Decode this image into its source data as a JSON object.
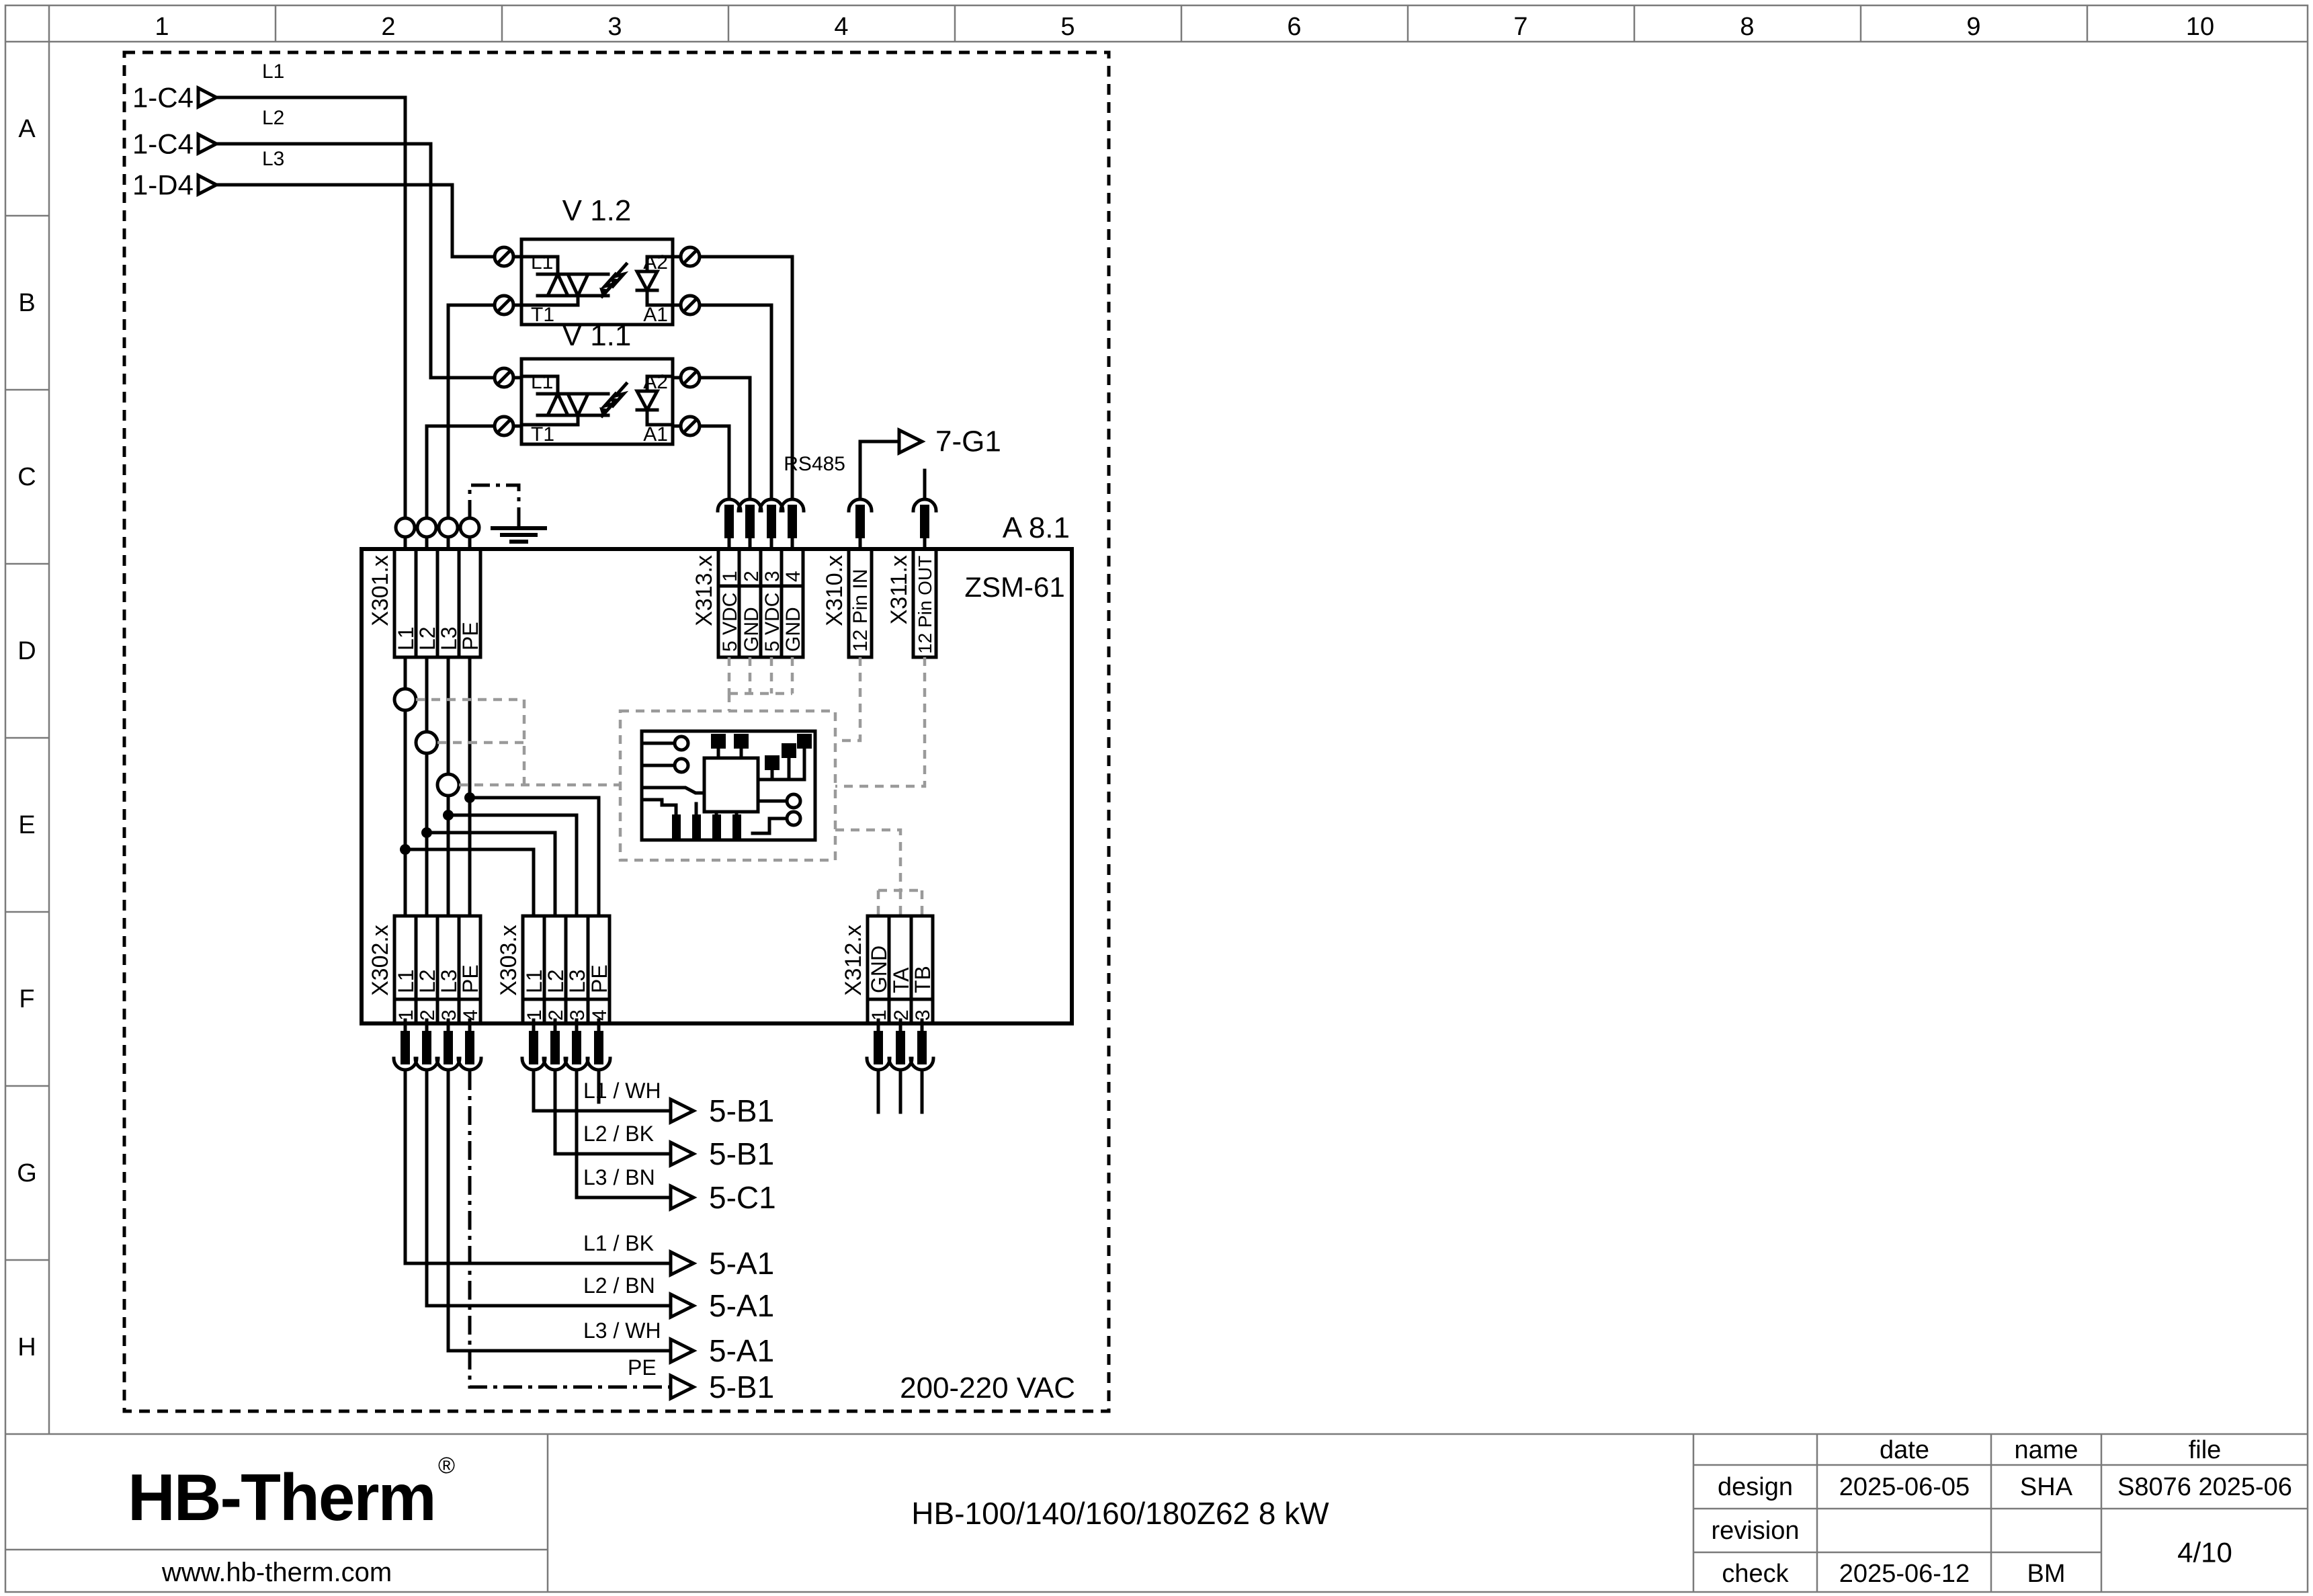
{
  "grid": {
    "cols": [
      "1",
      "2",
      "3",
      "4",
      "5",
      "6",
      "7",
      "8",
      "9",
      "10"
    ],
    "rows": [
      "A",
      "B",
      "C",
      "D",
      "E",
      "F",
      "G",
      "H"
    ]
  },
  "inputs": [
    {
      "ref": "1-C4",
      "phase": "L1"
    },
    {
      "ref": "1-C4",
      "phase": "L2"
    },
    {
      "ref": "1-D4",
      "phase": "L3"
    }
  ],
  "ssr": [
    {
      "id": "V 1.2",
      "in_top": "L1",
      "in_bottom": "T1",
      "out_top": "A2",
      "out_bottom": "A1"
    },
    {
      "id": "V 1.1",
      "in_top": "L1",
      "in_bottom": "T1",
      "out_top": "A2",
      "out_bottom": "A1"
    }
  ],
  "module": {
    "ref": "A 8.1",
    "name": "ZSM-61",
    "supply": "200-220 VAC"
  },
  "comm": {
    "bus": "RS485",
    "dest": "7-G1"
  },
  "connectors": {
    "x301": {
      "label": "X301.x",
      "pins": [
        "L1",
        "L2",
        "L3",
        "PE"
      ]
    },
    "x313": {
      "label": "X313.x",
      "nums": [
        "1",
        "2",
        "3",
        "4"
      ],
      "names": [
        "5 VDC",
        "GND",
        "5 VDC",
        "GND"
      ]
    },
    "x310": {
      "label": "X310.x",
      "name": "12 Pin IN"
    },
    "x311": {
      "label": "X311.x",
      "name": "12 Pin OUT"
    },
    "x302": {
      "label": "X302.x",
      "nums": [
        "1",
        "2",
        "3",
        "4"
      ],
      "names": [
        "L1",
        "L2",
        "L3",
        "PE"
      ]
    },
    "x303": {
      "label": "X303.x",
      "nums": [
        "1",
        "2",
        "3",
        "4"
      ],
      "names": [
        "L1",
        "L2",
        "L3",
        "PE"
      ]
    },
    "x312": {
      "label": "X312.x",
      "nums": [
        "1",
        "2",
        "3"
      ],
      "names": [
        "GND",
        "TA",
        "TB"
      ]
    }
  },
  "outputs_upper": [
    {
      "wire": "L1 / WH",
      "dest": "5-B1"
    },
    {
      "wire": "L2 / BK",
      "dest": "5-B1"
    },
    {
      "wire": "L3 / BN",
      "dest": "5-C1"
    }
  ],
  "outputs_lower": [
    {
      "wire": "L1 / BK",
      "dest": "5-A1"
    },
    {
      "wire": "L2 / BN",
      "dest": "5-A1"
    },
    {
      "wire": "L3 / WH",
      "dest": "5-A1"
    },
    {
      "wire": "PE",
      "dest": "5-B1"
    }
  ],
  "titleblock": {
    "logo": "HB-Therm",
    "registered": "®",
    "website": "www.hb-therm.com",
    "title": "HB-100/140/160/180Z62 8 kW",
    "col_date": "date",
    "col_name": "name",
    "col_file": "file",
    "rows": [
      {
        "label": "design",
        "date": "2025-06-05",
        "name": "SHA"
      },
      {
        "label": "revision",
        "date": "",
        "name": ""
      },
      {
        "label": "check",
        "date": "2025-06-12",
        "name": "BM"
      }
    ],
    "file_value": "S8076 2025-06",
    "page": "4/10"
  },
  "colors": {
    "line": "#000000",
    "dashed_gray": "#9a9a9a",
    "logo_navy": "#1b2b4d"
  }
}
